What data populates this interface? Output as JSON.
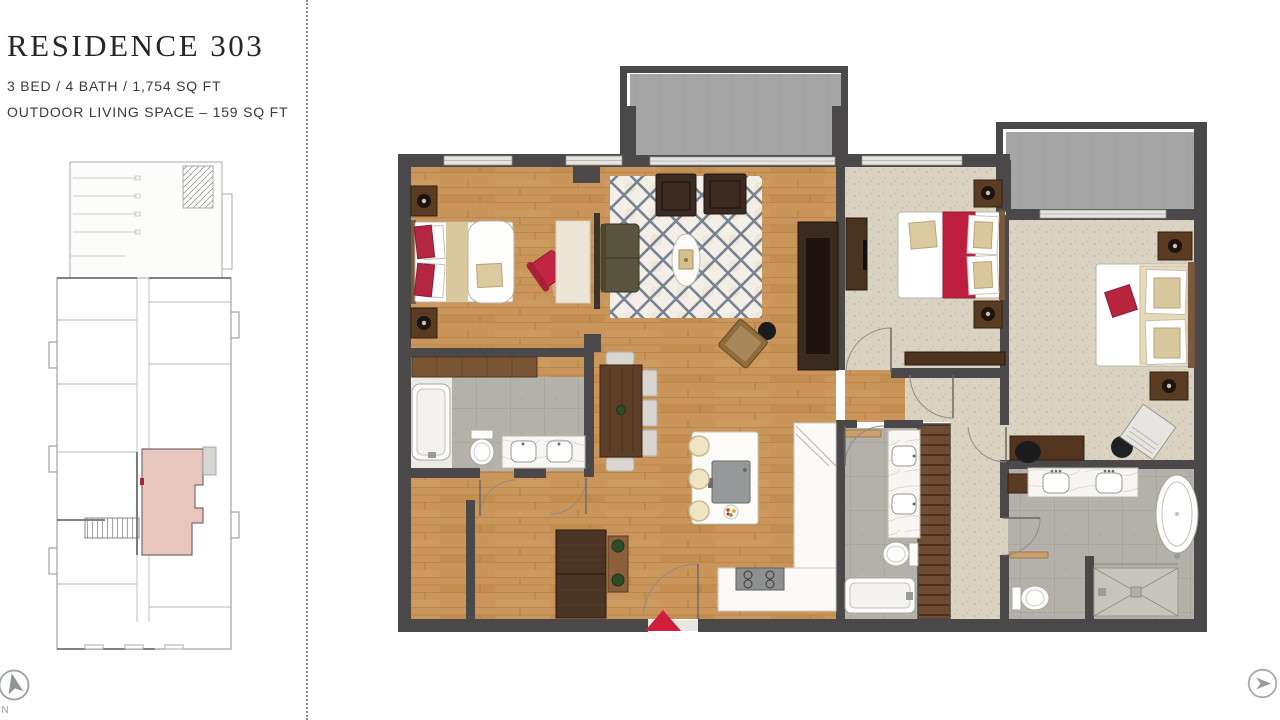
{
  "panel": {
    "title": "RESIDENCE 303",
    "specs_line1": "3 BED / 4 BATH / 1,754 SQ FT",
    "specs_line2": "OUTDOOR LIVING SPACE – 159 SQ FT"
  },
  "compass": {
    "label": "N"
  },
  "icons": {
    "compass": "compass-north-icon",
    "next_button": "next-arrow-icon"
  },
  "key_plan": {
    "highlight_color": "#e9c6bd",
    "door_marker_color": "#b4233a"
  },
  "floor_plan": {
    "unit_number": "303",
    "entry_arrow_color": "#cf1f3d",
    "wall_color": "#4a4848",
    "wood_floor_color": "#c79457",
    "carpet_color": "#d9d2c1",
    "tile_color": "#b4b1ab",
    "balcony_color": "#a5a5a6",
    "rug_accent_color": "#4d5d76",
    "accent_red": "#bf2440"
  }
}
